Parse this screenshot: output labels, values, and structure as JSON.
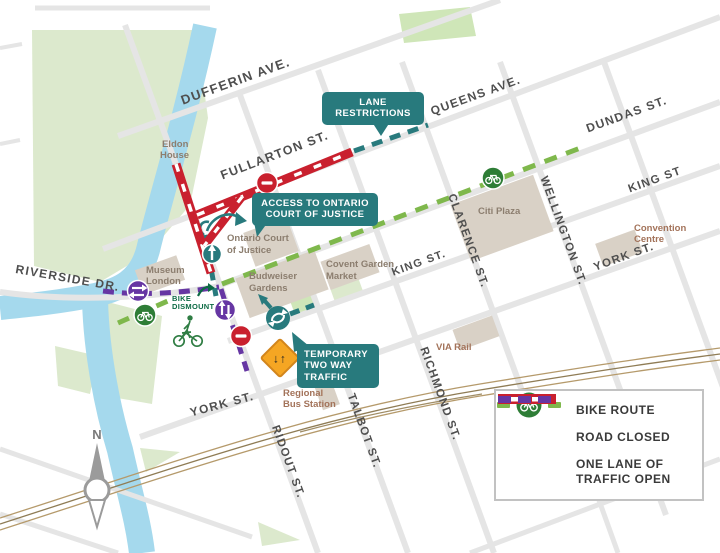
{
  "map": {
    "streets": {
      "dufferin": "DUFFERIN AVE.",
      "queens": "QUEENS AVE.",
      "dundas": "DUNDAS ST.",
      "fullarton": "FULLARTON ST.",
      "king_west": "KING ST.",
      "king_east": "KING ST",
      "york_center": "YORK ST.",
      "york_east": "YORK ST.",
      "riverside": "RIVERSIDE DR.",
      "ridout": "RIDOUT ST.",
      "talbot": "TALBOT ST.",
      "richmond": "RICHMOND ST.",
      "clarence": "CLARENCE ST.",
      "wellington": "WELLINGTON ST."
    },
    "places": {
      "eldon_house": [
        "Eldon",
        "House"
      ],
      "court": [
        "Ontario Court",
        "of Justice"
      ],
      "museum": [
        "Museum",
        "London"
      ],
      "budweiser": [
        "Budweiser",
        "Gardens"
      ],
      "covent": [
        "Covent Garden",
        "Market"
      ],
      "citi_plaza": "Citi Plaza",
      "convention": [
        "Convention",
        "Centre"
      ],
      "via_rail": "VIA Rail",
      "bus_station": [
        "Regional",
        "Bus Station"
      ]
    },
    "callouts": {
      "lane_restrictions": [
        "LANE",
        "RESTRICTIONS"
      ],
      "court_access": [
        "ACCESS TO ONTARIO",
        "COURT OF JUSTICE"
      ],
      "two_way": [
        "TEMPORARY",
        "TWO WAY",
        "TRAFFIC"
      ],
      "bike_dismount": [
        "BIKE",
        "DISMOUNT"
      ]
    },
    "signs": {
      "two_way_arrows": "↓↑"
    },
    "compass": "N"
  },
  "legend": {
    "items": [
      {
        "label": "BIKE ROUTE"
      },
      {
        "label": "ROAD CLOSED"
      },
      {
        "label": "ONE LANE OF TRAFFIC OPEN"
      }
    ]
  },
  "colors": {
    "bike_route": "#7fb84c",
    "bike_icon_green": "#2e7d36",
    "road_closed": "#c9202e",
    "one_lane_purple": "#6636a3",
    "advisory_teal": "#287a7d",
    "sign_orange": "#f5a623"
  }
}
